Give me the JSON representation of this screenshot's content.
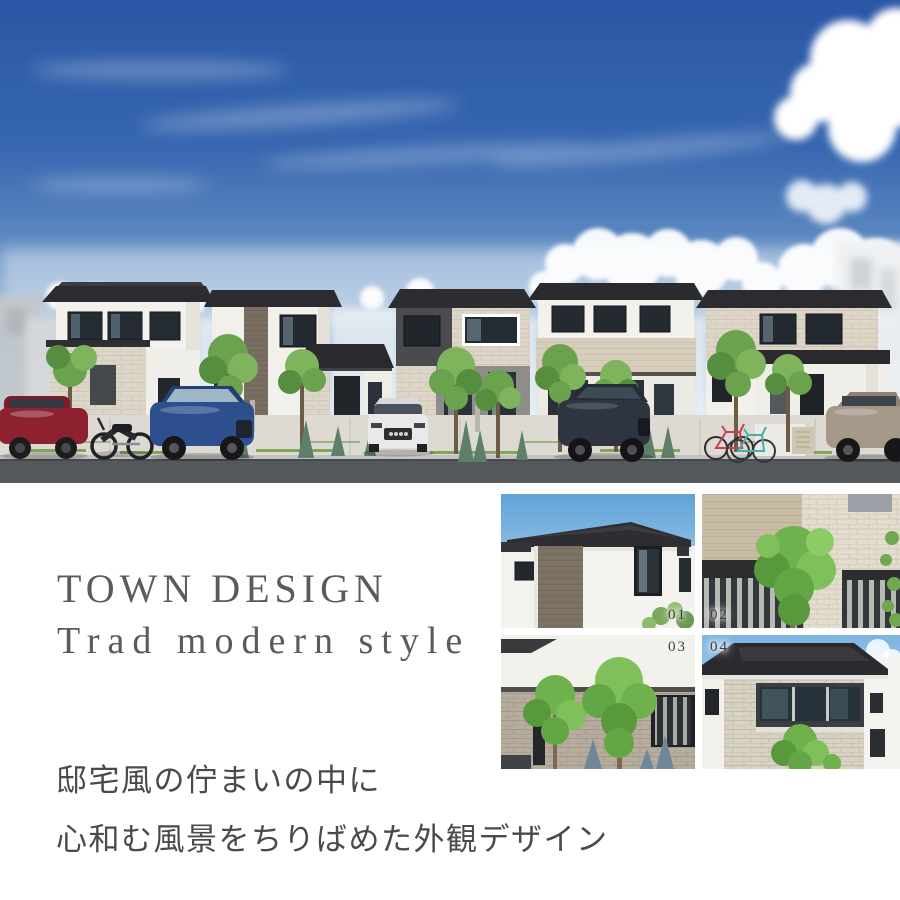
{
  "heading": {
    "title": "TOWN DESIGN",
    "subtitle": "Trad modern style"
  },
  "description": {
    "line1": "邸宅風の佇まいの中に",
    "line2": "心和む風景をちりばめた外観デザイン"
  },
  "gallery": {
    "items": [
      {
        "label": "01"
      },
      {
        "label": "02"
      },
      {
        "label": "03"
      },
      {
        "label": "04"
      }
    ]
  },
  "palette": {
    "page_background": "#ffffff",
    "heading_text": "#5b5b5e",
    "body_text": "#4a4a4c",
    "photo_label_text": "#3d3d40",
    "sky_top": "#2a57a5",
    "roof_dark": "#2c2b2f",
    "wall_white": "#f3f1ec",
    "stone_beige": "#ddd6c8",
    "road_gray": "#54575c"
  }
}
